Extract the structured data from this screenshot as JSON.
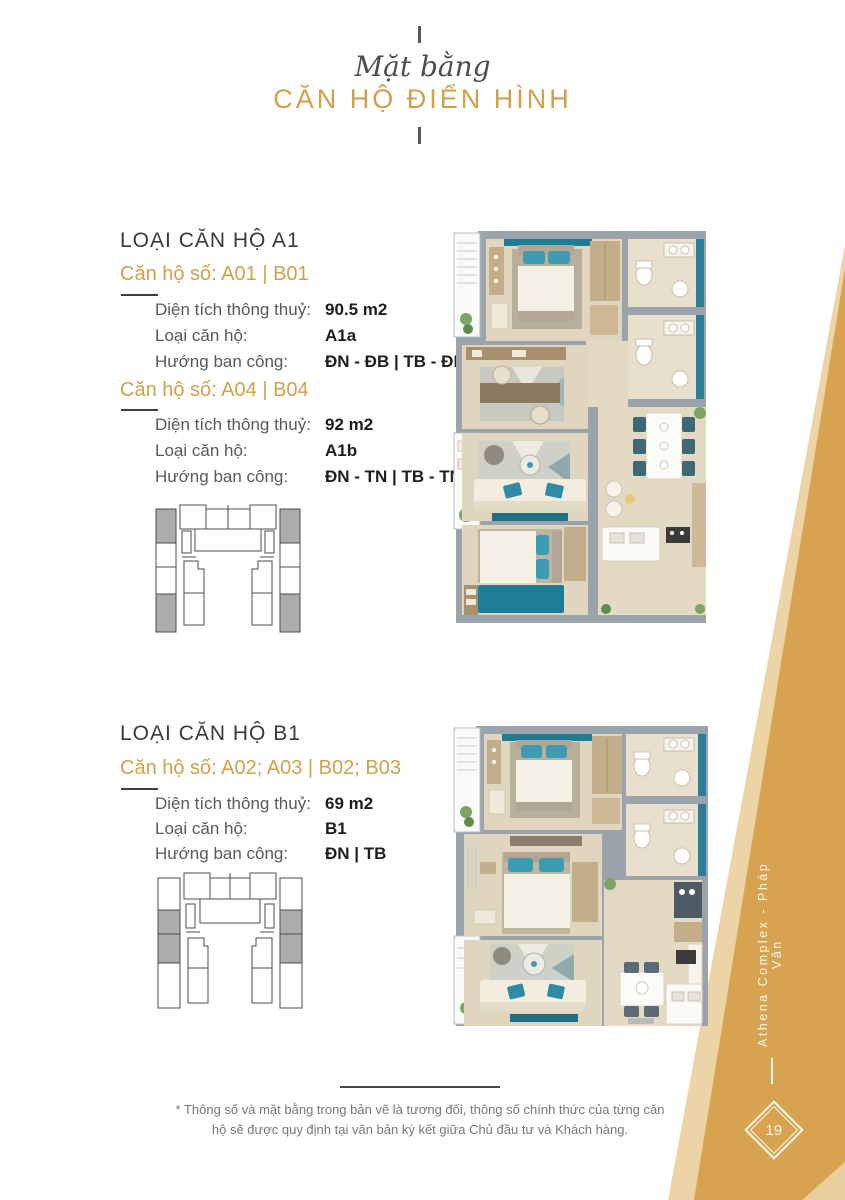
{
  "page": {
    "title_script": "Mặt bằng",
    "title_main": "CĂN HỘ ĐIỂN HÌNH",
    "side_band_text": "Athena Complex - Pháp Vân",
    "page_number": "19",
    "disclaimer": "* Thông số và mặt bằng trong bản vẽ là tương đối, thông số chính thức của từng căn hộ sẽ được quy định tại văn bản ký kết giữa Chủ đầu tư và Khách hàng."
  },
  "colors": {
    "gold": "#d2a04b",
    "gold_band": "#d7a351",
    "gold_band_light": "#ecd4a6",
    "teal_accent": "#1e7c96",
    "wall_gray": "#9ca4ab"
  },
  "sections": [
    {
      "heading": "LOẠI CĂN HỘ A1",
      "units": [
        {
          "subheading": "Căn hộ số: A01 | B01",
          "rows": [
            {
              "label": "Diện tích thông thuỷ:",
              "value": "90.5 m2"
            },
            {
              "label": "Loại căn hộ:",
              "value": "A1a"
            },
            {
              "label": "Hướng ban công:",
              "value": "ĐN - ĐB | TB - ĐB"
            }
          ]
        },
        {
          "subheading": "Căn hộ số: A04 | B04",
          "rows": [
            {
              "label": "Diện tích thông thuỷ:",
              "value": "92 m2"
            },
            {
              "label": "Loại căn hộ:",
              "value": "A1b"
            },
            {
              "label": "Hướng ban công:",
              "value": "ĐN - TN | TB - TN"
            }
          ]
        }
      ]
    },
    {
      "heading": "LOẠI CĂN HỘ B1",
      "units": [
        {
          "subheading": "Căn hộ số: A02; A03 | B02; B03",
          "rows": [
            {
              "label": "Diện tích thông thuỷ:",
              "value": "69 m2"
            },
            {
              "label": "Loại căn hộ:",
              "value": "B1"
            },
            {
              "label": "Hướng ban công:",
              "value": "ĐN | TB"
            }
          ]
        }
      ]
    }
  ]
}
